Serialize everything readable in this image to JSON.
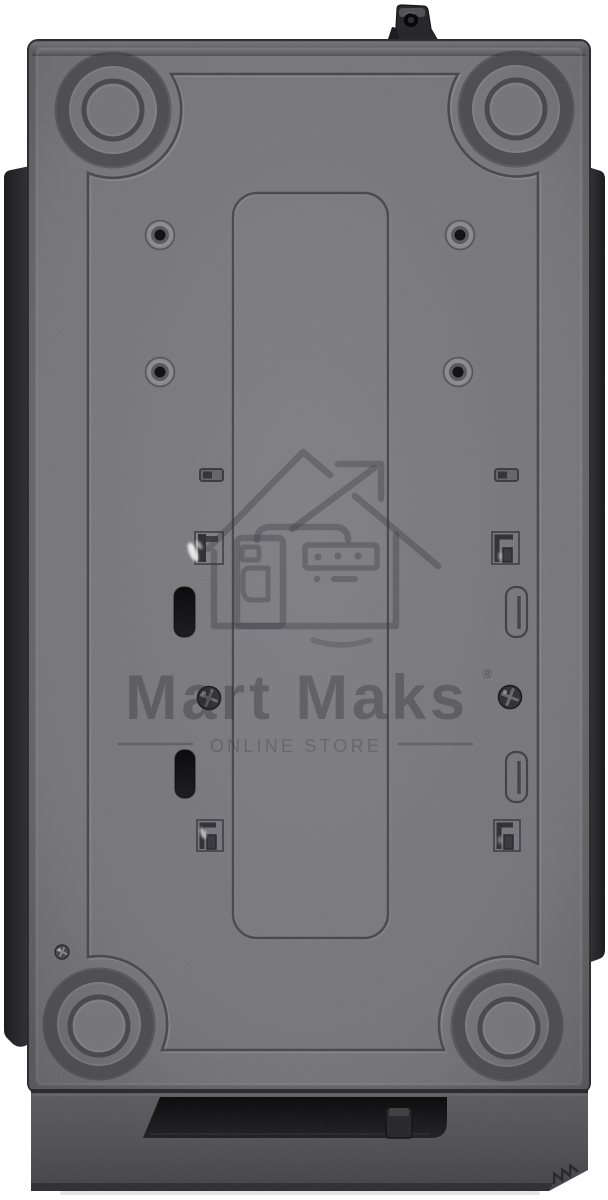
{
  "watermark": {
    "brand_name": "Mart Maks",
    "registered_symbol": "®",
    "tagline": "ONLINE STORE",
    "logo_icon": "house-store-growth-arrow-icon"
  },
  "colors": {
    "background": "#ffffff",
    "panel_base": "#757578",
    "panel_center": "#7d7d81",
    "panel_edge": "#5e5e62",
    "groove": "#434347",
    "slot_black": "#0a0a0c",
    "bezel": "#525256",
    "bezel_bottom": "#39393d",
    "recess_black": "#0d0d0f",
    "side_strip": "#2a2a2d",
    "watermark_ink": "#3a3a3f"
  }
}
